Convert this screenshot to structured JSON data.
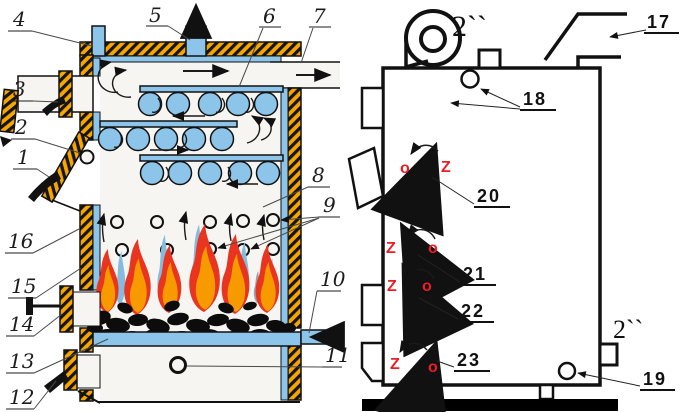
{
  "title": "solid-fuel-boiler-diagram",
  "colors": {
    "hatch_yellow": "#F7A600",
    "water_blue": "#8CC5E9",
    "flame_red": "#E93420",
    "flame_orange": "#F79A00",
    "flame_blue": "#85BBDD",
    "flame_gray": "#9AA3AB",
    "coal_black": "#0C0C0C",
    "callout_red": "#EE1C25"
  },
  "left_diagram": {
    "callouts": {
      "c1": "1",
      "c2": "2",
      "c3": "3",
      "c4": "4",
      "c5": "5",
      "c6": "6",
      "c7": "7",
      "c8": "8",
      "c9": "9",
      "c10": "10",
      "c11": "11",
      "c12": "12",
      "c13": "13",
      "c14": "14",
      "c15": "15",
      "c16": "16"
    }
  },
  "right_diagram": {
    "callouts": {
      "c17": "17",
      "c18": "18",
      "c19": "19",
      "c20": "20",
      "c21": "21",
      "c22": "22",
      "c23": "23"
    },
    "pipe_size_top": "2``",
    "pipe_size_bottom": "2``",
    "damper_open_letter": "o",
    "damper_closed_letter": "Z"
  }
}
